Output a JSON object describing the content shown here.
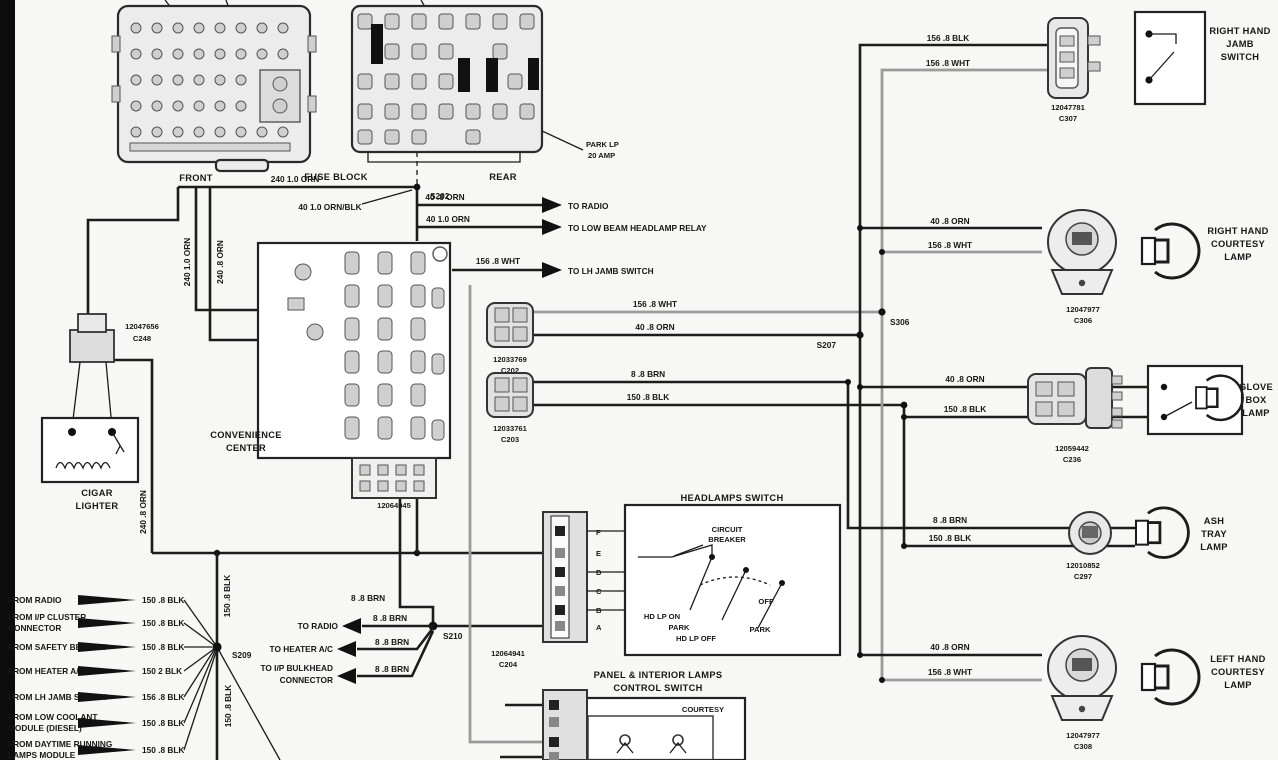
{
  "labels": {
    "front": "FRONT",
    "fuse_block": "FUSE BLOCK",
    "rear": "REAR",
    "park_fuse": [
      "PARK LP",
      "20 AMP"
    ],
    "convenience": [
      "CONVENIENCE",
      "CENTER"
    ],
    "cigar": [
      "CIGAR",
      "LIGHTER"
    ],
    "headlamps_switch": "HEADLAMPS SWITCH",
    "circuit_breaker": [
      "CIRCUIT",
      "BREAKER"
    ],
    "hd_lp_on": "HD LP ON",
    "park": "PARK",
    "hd_lp_off": "HD LP OFF",
    "off": "OFF",
    "panel_switch": [
      "PANEL & INTERIOR LAMPS",
      "CONTROL SWITCH"
    ],
    "courtesy": "COURTESY",
    "rh_jamb": [
      "RIGHT HAND",
      "JAMB",
      "SWITCH"
    ],
    "rh_courtesy": [
      "RIGHT HAND",
      "COURTESY",
      "LAMP"
    ],
    "glove": [
      "GLOVE",
      "BOX",
      "LAMP"
    ],
    "ash": [
      "ASH",
      "TRAY",
      "LAMP"
    ],
    "lh_courtesy": [
      "LEFT HAND",
      "COURTESY",
      "LAMP"
    ]
  },
  "wires": {
    "w240_10_orn": "240 1.0 ORN",
    "w240_8_orn": "240 .8 ORN",
    "w40_10_ornblk": "40 1.0 ORN/BLK",
    "w40_8_orn": "40 .8 ORN",
    "w40_10_orn": "40 1.0 ORN",
    "w156_8_wht": "156 .8 WHT",
    "w156_8_blk": "156 .8 BLK",
    "w150_8_blk": "150 .8 BLK",
    "w150_2_blk": "150 2 BLK",
    "w8_8_brn": "8 .8 BRN"
  },
  "splices": {
    "s202": "S202",
    "s207": "S207",
    "s306": "S306",
    "s209": "S209",
    "s210": "S210"
  },
  "connectors": {
    "c307": [
      "12047781",
      "C307"
    ],
    "c306": [
      "12047977",
      "C306"
    ],
    "c236": [
      "12059442",
      "C236"
    ],
    "c297": [
      "12010852",
      "C297"
    ],
    "c308": [
      "12047977",
      "C308"
    ],
    "c248": [
      "12047656",
      "C248"
    ],
    "c202": [
      "12033769",
      "C202"
    ],
    "c203": [
      "12033761",
      "C203"
    ],
    "c204": [
      "12064941",
      "C204"
    ],
    "conv": "12064945"
  },
  "pins": [
    "F",
    "E",
    "D",
    "C",
    "B",
    "A"
  ],
  "feed_arrows": [
    {
      "w": "40 .8 ORN",
      "t": "TO RADIO"
    },
    {
      "w": "40 1.0 ORN",
      "t": "TO LOW BEAM HEADLAMP RELAY"
    },
    {
      "w": "156 .8 WHT",
      "t": "TO LH JAMB SWITCH"
    }
  ],
  "from_rows": [
    {
      "t": [
        "FROM RADIO"
      ],
      "w": "150 .8 BLK"
    },
    {
      "t": [
        "FROM I/P CLUSTER",
        "CONNECTOR"
      ],
      "w": "150 .8 BLK"
    },
    {
      "t": [
        "FROM SAFETY BELT SW"
      ],
      "w": "150 .8 BLK"
    },
    {
      "t": [
        "FROM HEATER A/C"
      ],
      "w": "150 2 BLK"
    },
    {
      "t": [
        "FROM LH JAMB SWITCH"
      ],
      "w": "156 .8 BLK"
    },
    {
      "t": [
        "FROM LOW COOLANT",
        "MODULE (DIESEL)"
      ],
      "w": "150 .8 BLK"
    },
    {
      "t": [
        "FROM DAYTIME RUNNING",
        "LAMPS MODULE"
      ],
      "w": "150 .8 BLK"
    }
  ],
  "to_rows": [
    {
      "t": [
        "TO RADIO"
      ],
      "w": "8 .8 BRN"
    },
    {
      "t": [
        "TO HEATER A/C"
      ],
      "w": "8 .8 BRN"
    },
    {
      "t": [
        "TO I/P BULKHEAD",
        "CONNECTOR"
      ],
      "w": "8 .8 BRN"
    }
  ]
}
